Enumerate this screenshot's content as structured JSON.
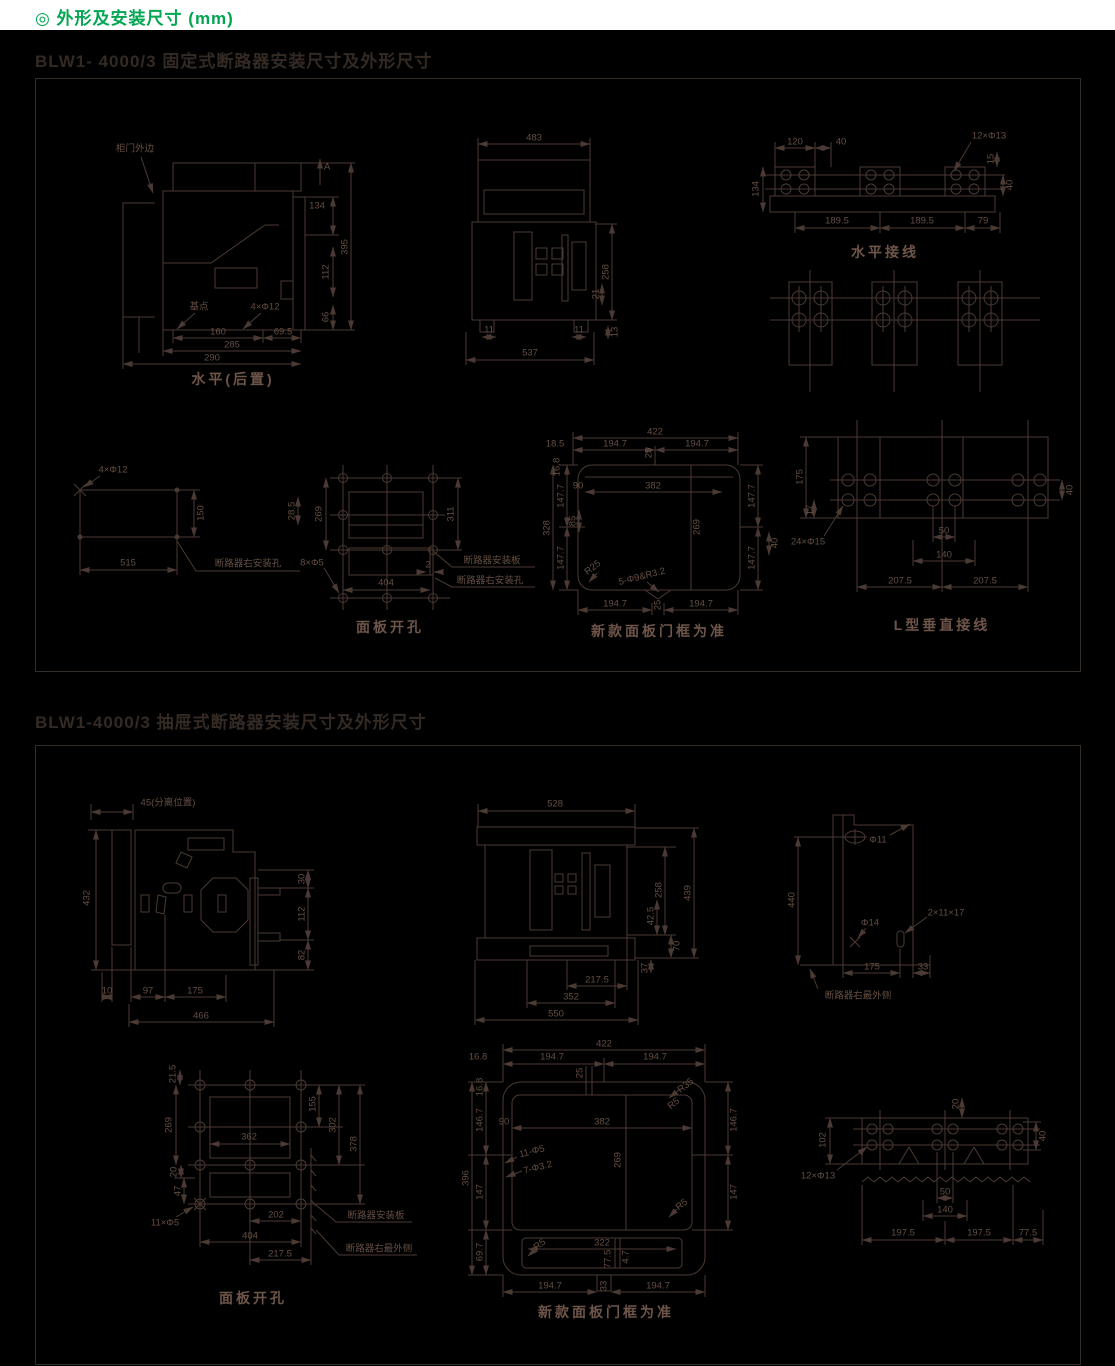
{
  "header": {
    "title": "◎ 外形及安装尺寸 (mm)"
  },
  "sections": {
    "fixed": "BLW1- 4000/3 固定式断路器安装尺寸及外形尺寸",
    "drawer": "BLW1-4000/3 抽屉式断路器安装尺寸及外形尺寸"
  },
  "colors": {
    "accent_green": "#00a651",
    "line": "#4b3a33",
    "panel_bg": "#000000"
  },
  "s1": {
    "side": {
      "caption": "水平(后置)",
      "door_edge": "柜门外边",
      "arrow_a": "A",
      "base_point": "基点",
      "holes": "4×Φ12",
      "d134": "134",
      "d112": "112",
      "d66": "66",
      "d395": "395",
      "d160": "160",
      "d69_5": "69.5",
      "d285": "285",
      "d290": "290"
    },
    "front": {
      "d483": "483",
      "d258": "258",
      "d21": "21",
      "d13": "13",
      "d11": "11",
      "d537": "537"
    },
    "hconn": {
      "caption": "水平接线",
      "d120": "120",
      "d40": "40",
      "d134": "134",
      "holes": "12×Φ13",
      "d15": "15",
      "d189_5": "189.5",
      "d79": "79"
    },
    "rmount": {
      "holes": "4×Φ12",
      "d150": "150",
      "d515": "515",
      "note": "断路器右安装孔"
    },
    "cutout": {
      "caption": "面板开孔",
      "d28_5": "28.5",
      "d269": "269",
      "d311": "311",
      "d404": "404",
      "d2": "2",
      "holes": "8×Φ5",
      "note_plate": "断路器安装板",
      "note_hole": "断路器右安装孔"
    },
    "frame": {
      "caption": "新款面板门框为准",
      "d422": "422",
      "d194_7": "194.7",
      "d18_5": "18.5",
      "d16_8": "16.8",
      "d147_7": "147.7",
      "d328": "328",
      "d90": "90",
      "d85": "85",
      "d382": "382",
      "d269": "269",
      "d25": "25",
      "d40": "40",
      "r25": "R25",
      "note": "5-Φ9&R3.2"
    },
    "lconn": {
      "caption": "L型垂直接线",
      "d175": "175",
      "d17": "17",
      "holes": "24×Φ15",
      "d50": "50",
      "d140": "140",
      "d207_5": "207.5",
      "d40": "40"
    }
  },
  "s2": {
    "side": {
      "sep": "45(分离位置)",
      "d432": "432",
      "d30": "30",
      "d112": "112",
      "d82": "82",
      "d10": "10",
      "d97": "97",
      "d175": "175",
      "d466": "466"
    },
    "front": {
      "d528": "528",
      "d258": "258",
      "d439": "439",
      "d42_5": "42.5",
      "d70": "70",
      "d37": "37",
      "d217_5": "217.5",
      "d352": "352",
      "d550": "550"
    },
    "rside": {
      "phi11": "Φ11",
      "d440": "440",
      "phi14": "Φ14",
      "slot": "2×11×17",
      "d175": "175",
      "d33": "33",
      "note": "断路器右最外侧"
    },
    "cutout": {
      "caption": "面板开孔",
      "d21_5": "21.5",
      "d269": "269",
      "d20": "20",
      "d47": "47",
      "d362": "362",
      "d155": "155",
      "d302": "302",
      "d378": "378",
      "d202": "202",
      "d404": "404",
      "d217_5": "217.5",
      "holes": "11×Φ5",
      "note_plate": "断路器安装板",
      "note_edge": "断路器右最外侧"
    },
    "frame": {
      "caption": "新款面板门框为准",
      "d422": "422",
      "d194_7": "194.7",
      "d16_8": "16.8",
      "d146_7": "146.7",
      "d147": "147",
      "d396": "396",
      "d69_7": "69.7",
      "d25": "25",
      "d90": "90",
      "d382": "382",
      "d269": "269",
      "d322": "322",
      "d77_5": "77.5",
      "d4_7": "4.7",
      "d33": "33",
      "r35": "R35",
      "r5": "R5",
      "h1": "11-Φ5",
      "h2": "7-Φ3.2"
    },
    "conn": {
      "d102": "102",
      "d20": "20",
      "d40": "40",
      "holes": "12×Φ13",
      "d50": "50",
      "d140": "140",
      "d197_5": "197.5",
      "d77_5": "77.5"
    }
  }
}
